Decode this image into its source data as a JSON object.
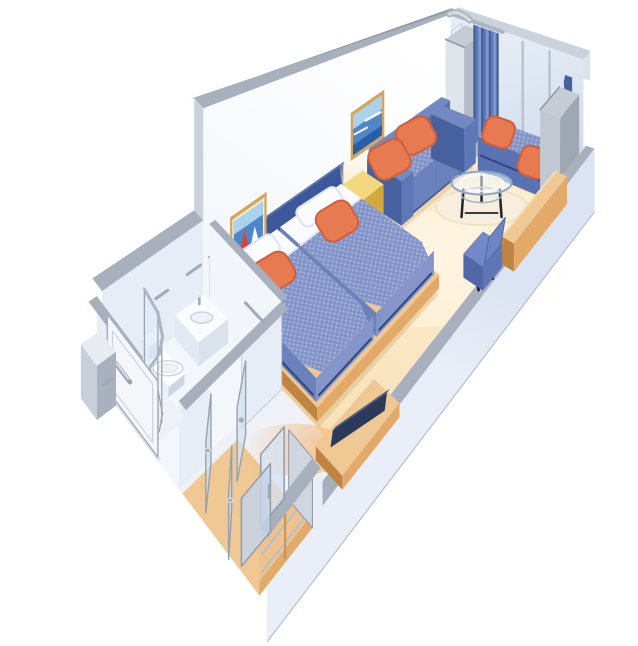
{
  "meta": {
    "description": "Isometric cutaway floor plan of a cruise ship stateroom with two twin beds, sofa sitting area, curtained window with bench seat, glass coffee table, desk chair, television, wardrobe closet, entry corridor and bathroom with shower, toilet and sink",
    "background": "#ffffff"
  },
  "palette": {
    "white": "#ffffff",
    "wall_face": "#fdfdfe",
    "wall_face_shade": "#eef1f6",
    "cap": "#a9b0bd",
    "cap_dark": "#8e96a3",
    "cap_light": "#ccd2db",
    "cap_top": "#c6ccd6",
    "glass_hi": "#e6edf6",
    "glass_lo": "#cdd9ea",
    "mullion": "#b9c2cf",
    "band_outer_hi": "#dce3f2",
    "band_outer_lo": "#e9eef8",
    "band_inner": "#e6ebf4",
    "floor_hi": "#fdeecf",
    "floor_lo": "#f6dcb2",
    "floor_bath": "#f3f6fa",
    "floor_hall": "#eef1f6",
    "wood_hi": "#f0c894",
    "wood": "#e2a968",
    "wood_dark": "#c08442",
    "wood_deep": "#a56c2e",
    "rug": "#f8eedd",
    "rug_edge": "#efe2ca",
    "curtain": "#5d78b6",
    "curtain_dark": "#46619e",
    "curtain_hi": "#8099cc",
    "navy": "#3c589a",
    "navy_deep": "#2f4781",
    "uph": "#8496c9",
    "uph_dot": "#aab7dd",
    "uph_dark": "#5872b2",
    "uph_side": "#6b81bc",
    "sofa": "#5e77b6",
    "sofa_dark": "#47619e",
    "sofa_hi": "#7289c4",
    "orange": "#e87a52",
    "orange_dark": "#cf5f3b",
    "orange_hi": "#f29268",
    "yellow_hi": "#f4d87f",
    "yellow": "#e9c257",
    "yellow_dark": "#d3a83e",
    "chair": "#7388c5",
    "chair_dark": "#5068a8",
    "tv": "#2b3a5a",
    "tv_edge": "#47587e",
    "porc": "#ffffff",
    "porc_shade": "#e2e9f2",
    "porc_dark": "#ccd6e2",
    "chrome": "#9fabb9",
    "chrome_hi": "#dde3ea",
    "gold": "#d6a55c",
    "mat": "#f3ead2",
    "art_sky": "#a9d2ec",
    "art_sea": "#4f86c8",
    "art_deep": "#2a5ea8",
    "art_red": "#d8452f",
    "art_navy": "#1d3158",
    "art_white": "#f4f8fc",
    "glass_fill": "rgba(214,226,241,0.75)",
    "glass_fill2": "rgba(196,211,232,0.85)",
    "glass_stroke": "#97a1af",
    "shadow_warm": "rgba(213,176,122,0.42)",
    "ink": "#1a1c22"
  },
  "rooms": [
    {
      "id": "main-cabin",
      "label": "Main cabin with twin beds"
    },
    {
      "id": "sitting-area",
      "label": "Sitting area with sofa, window bench and coffee table"
    },
    {
      "id": "bathroom",
      "label": "Bathroom with shower, toilet and sink"
    },
    {
      "id": "entry-corridor",
      "label": "Entry corridor"
    },
    {
      "id": "closet",
      "label": "Wardrobe closet with sliding glass doors"
    }
  ],
  "objects": [
    {
      "id": "picture-wall",
      "label": "long cabin wall with framed pictures"
    },
    {
      "id": "window-wall",
      "label": "window wall with glass panels"
    },
    {
      "id": "window-curtains",
      "label": "pleated blue curtains"
    },
    {
      "id": "curtain-valance",
      "label": "curved curtain track"
    },
    {
      "id": "curtain-bunch",
      "label": "gathered dark curtain"
    },
    {
      "id": "wardrobe-column",
      "label": "tall cabinet column beside window"
    },
    {
      "id": "divider-panel",
      "label": "tall mirror divider panel"
    },
    {
      "id": "corner-cabinet",
      "label": "gray corner cabinet"
    },
    {
      "id": "seascape-picture",
      "label": "framed seascape picture above sofa"
    },
    {
      "id": "sailboat-picture",
      "label": "framed sailboat picture above beds"
    },
    {
      "id": "headboard-panel",
      "label": "navy headboard panel"
    },
    {
      "id": "sofa",
      "label": "blue loveseat sofa with orange pillows"
    },
    {
      "id": "side-table",
      "label": "yellow side cabinet"
    },
    {
      "id": "window-bench",
      "label": "window bench seat with orange pillows"
    },
    {
      "id": "area-rug",
      "label": "round pale rug"
    },
    {
      "id": "coffee-table",
      "label": "round glass coffee table"
    },
    {
      "id": "twin-bed-right",
      "label": "twin bed with blue bedspread and orange pillow"
    },
    {
      "id": "twin-bed-left",
      "label": "twin bed with blue bedspread and orange pillow"
    },
    {
      "id": "desk-counter",
      "label": "wooden desk counter along wall"
    },
    {
      "id": "desk-chair",
      "label": "blue desk chair"
    },
    {
      "id": "tv-cabinet",
      "label": "low wooden cabinet"
    },
    {
      "id": "television",
      "label": "flat television"
    },
    {
      "id": "near-wall",
      "label": "low cutaway cabin wall"
    },
    {
      "id": "outer-hull-wall",
      "label": "outer hull wall band"
    },
    {
      "id": "bathroom-walls",
      "label": "bathroom partition walls"
    },
    {
      "id": "shower-enclosure",
      "label": "curved glass shower"
    },
    {
      "id": "toilet",
      "label": "toilet"
    },
    {
      "id": "sink-vanity",
      "label": "sink vanity counter"
    },
    {
      "id": "towel-bars",
      "label": "chrome towel bars"
    },
    {
      "id": "bathroom-door",
      "label": "bathroom glass door"
    },
    {
      "id": "closet-shelves",
      "label": "closet interior shelves"
    },
    {
      "id": "closet-sliding-doors",
      "label": "closet sliding glass doors"
    },
    {
      "id": "corridor-glass-panels",
      "label": "open glass door panels in corridor"
    },
    {
      "id": "entry-door",
      "label": "cabin entry door with handle"
    },
    {
      "id": "door-jamb",
      "label": "entry door jamb block"
    }
  ]
}
